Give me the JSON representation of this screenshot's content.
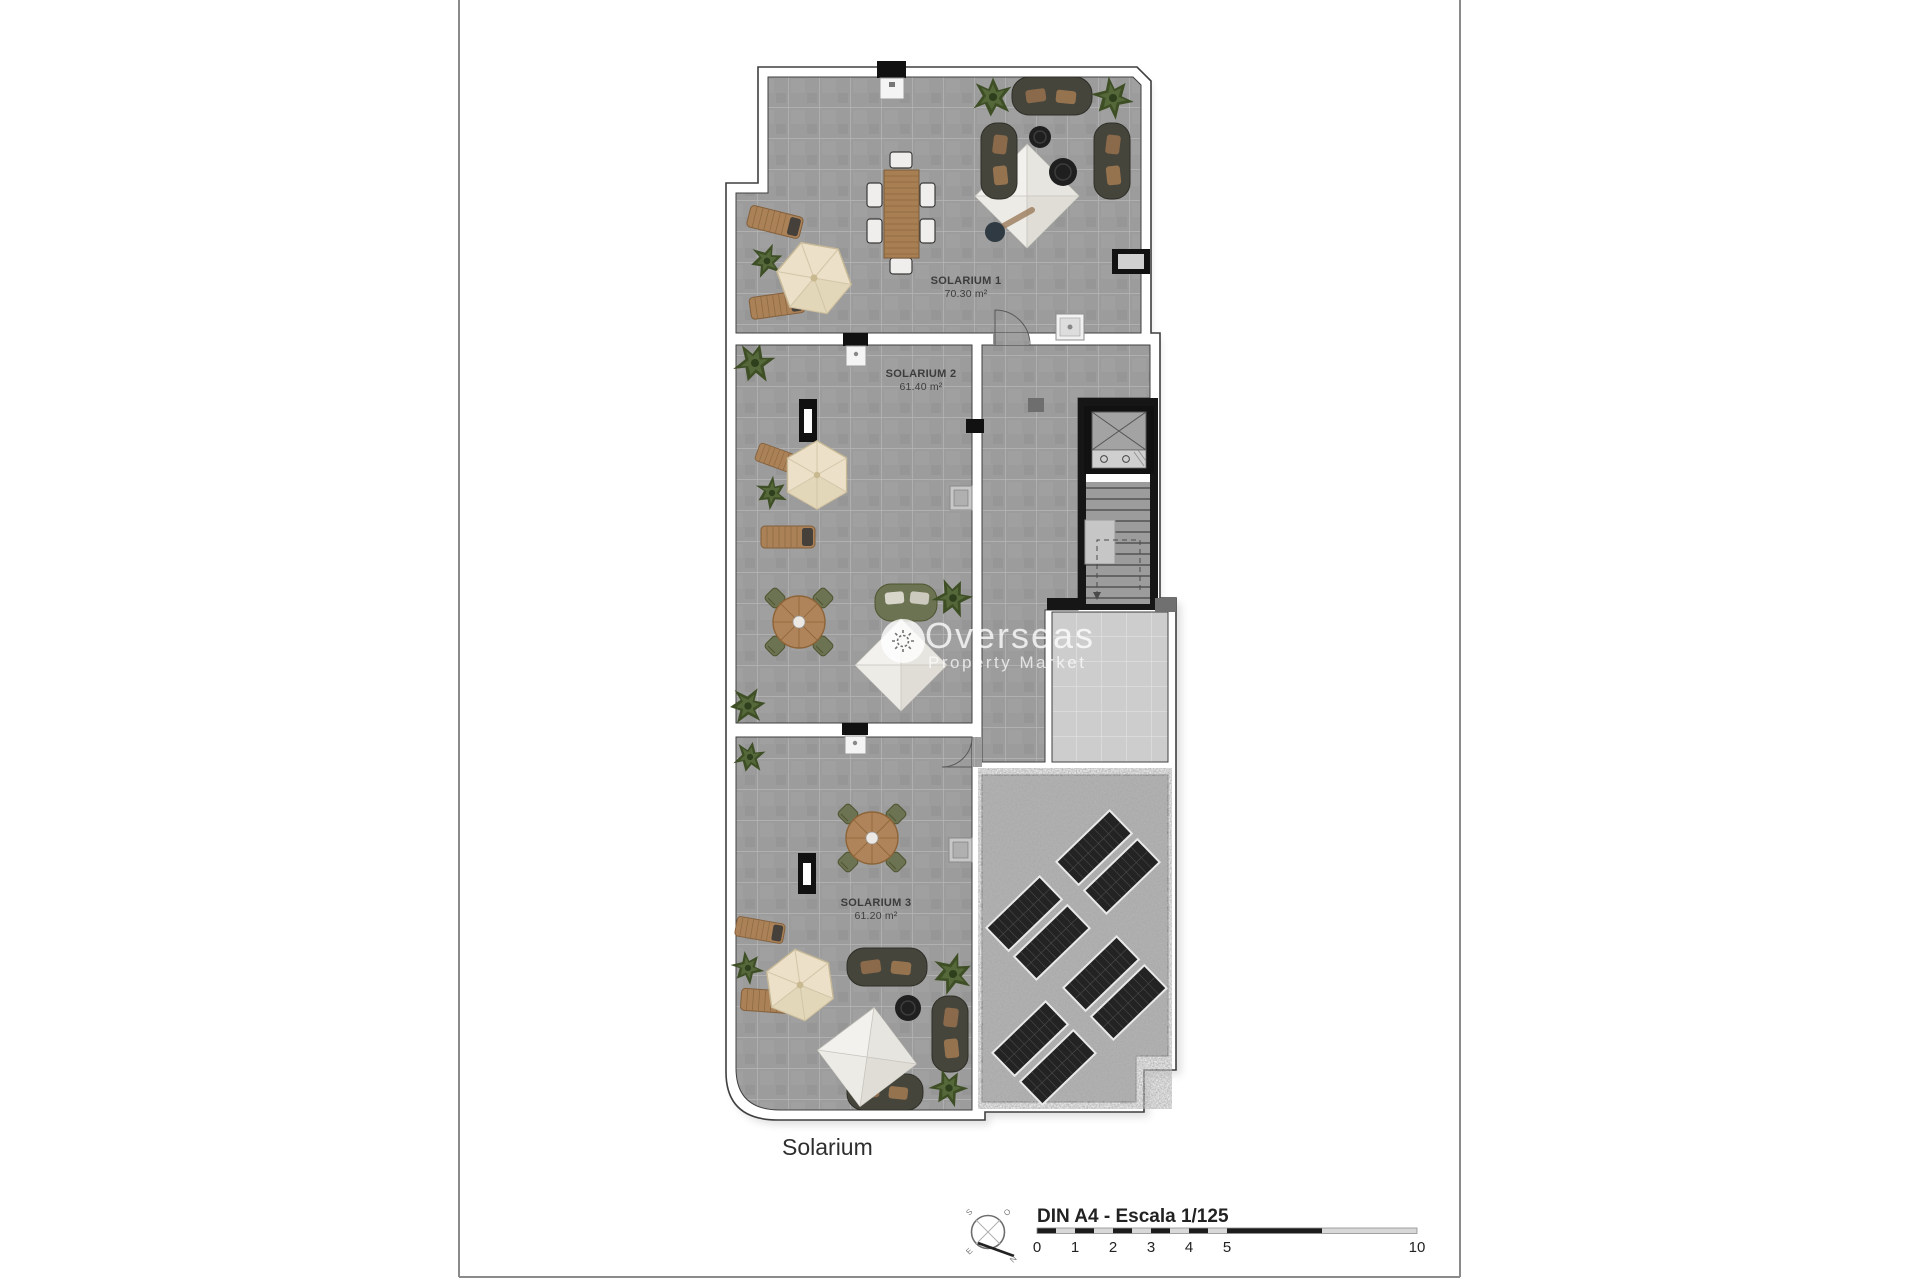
{
  "page": {
    "caption": "Solarium"
  },
  "rooms": [
    {
      "name": "SOLARIUM 1",
      "area": "70.30 m²"
    },
    {
      "name": "SOLARIUM 2",
      "area": "61.40 m²"
    },
    {
      "name": "SOLARIUM 3",
      "area": "61.20 m²"
    }
  ],
  "watermark": {
    "line1": "Overseas",
    "line2": "Property Market"
  },
  "scale_bar": {
    "label": "DIN A4 - Escala 1/125",
    "ticks": [
      "0",
      "1",
      "2",
      "3",
      "4",
      "5",
      "10"
    ]
  },
  "compass": {
    "north": "N",
    "south": "S",
    "east": "E",
    "west": "O"
  },
  "colors": {
    "tile": "#9c9c9c",
    "tile_light": "#cdcdcd",
    "gravel_base": "#a6a6a6",
    "wall": "#ffffff",
    "outline": "#3f3f3f",
    "wood": "#a87f52",
    "olive": "#6c7352",
    "panel_cell": "#232323",
    "parasol": "#ece1c8",
    "frame_line": "#8a8a8a"
  }
}
